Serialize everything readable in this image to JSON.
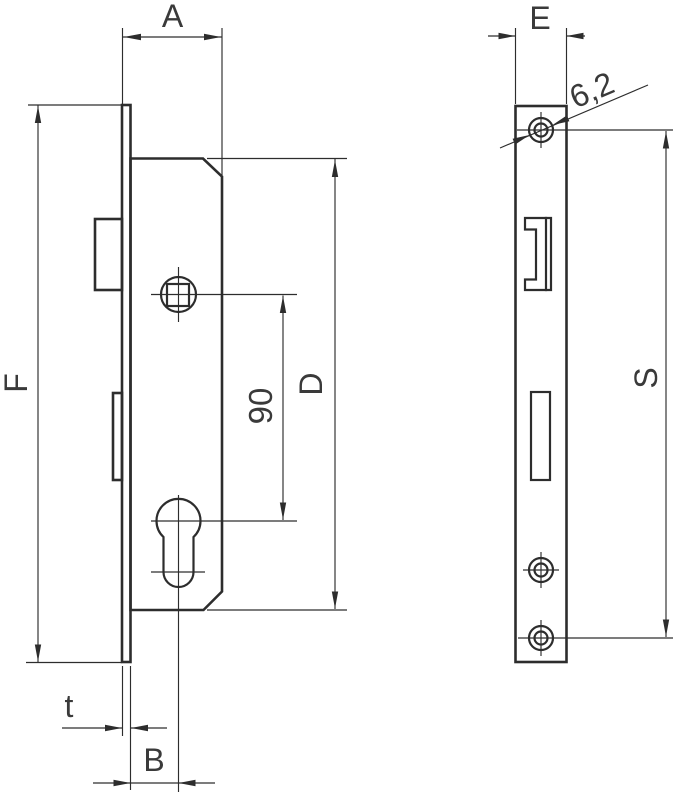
{
  "drawing": {
    "colors": {
      "line": "#2d2d2d",
      "text": "#3a3a3a",
      "background": "#ffffff"
    },
    "labels": {
      "a": "A",
      "e": "E",
      "f": "F",
      "d": "D",
      "s": "S",
      "t": "t",
      "b": "B",
      "center_distance": "90",
      "hole_diameter": "6,2"
    }
  }
}
